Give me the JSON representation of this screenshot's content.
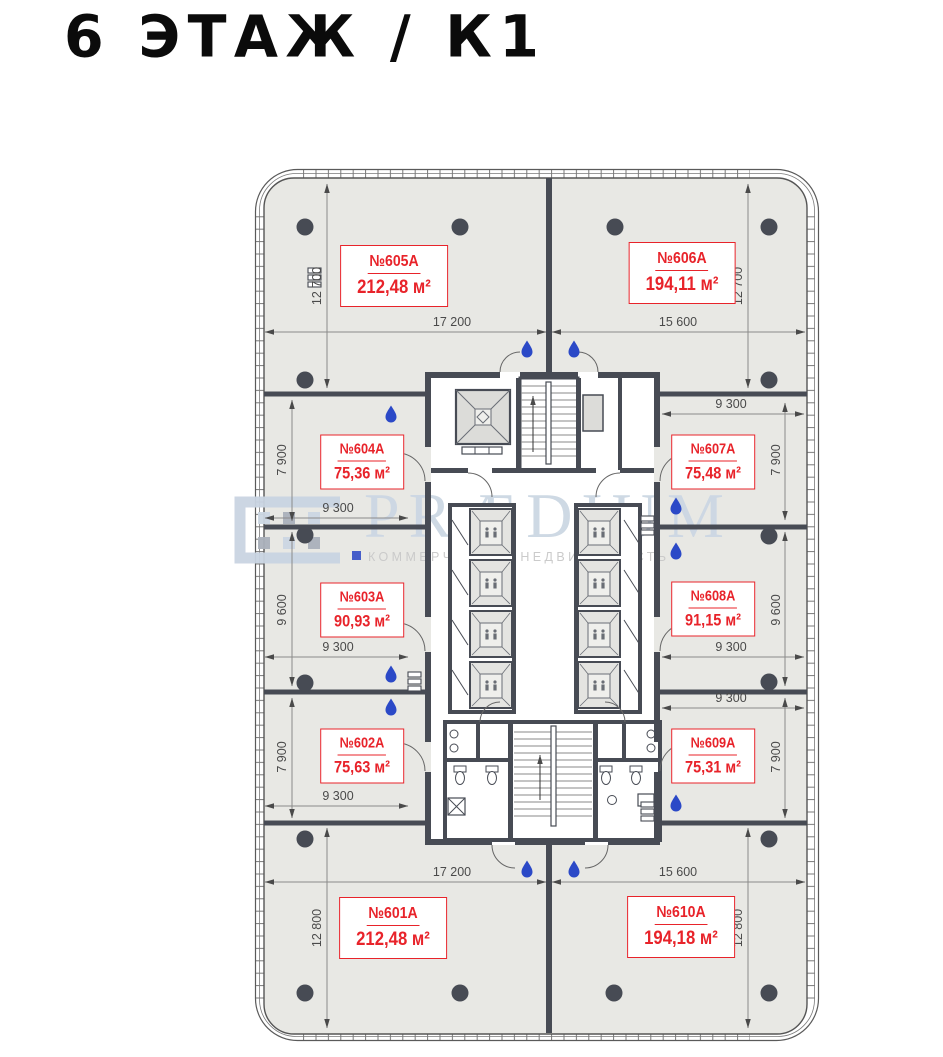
{
  "header": {
    "title": "6 ЭТАЖ / К1"
  },
  "units": [
    {
      "number": "№605А",
      "area": "212,48 м²"
    },
    {
      "number": "№606А",
      "area": "194,11 м²"
    },
    {
      "number": "№604А",
      "area": "75,36 м²"
    },
    {
      "number": "№607А",
      "area": "75,48 м²"
    },
    {
      "number": "№603А",
      "area": "90,93 м²"
    },
    {
      "number": "№608А",
      "area": "91,15 м²"
    },
    {
      "number": "№602А",
      "area": "75,63 м²"
    },
    {
      "number": "№609А",
      "area": "75,31 м²"
    },
    {
      "number": "№601А",
      "area": "212,48 м²"
    },
    {
      "number": "№610А",
      "area": "194,18 м²"
    }
  ],
  "dimensions": {
    "top": [
      "17 200",
      "15 600"
    ],
    "bottom": [
      "17 200",
      "15 600"
    ],
    "left": [
      "12 700",
      "7 900",
      "9 600",
      "7 900",
      "12 800"
    ],
    "right": [
      "12 700",
      "7 900",
      "9 600",
      "7 900",
      "12 800"
    ],
    "inner_left": [
      "9 300",
      "9 300",
      "9 300"
    ],
    "inner_right": [
      "9 300",
      "9 300",
      "9 300"
    ]
  },
  "watermark": {
    "brand": "PRÆDIUM",
    "subtitle": "КОММЕРЧЕСКАЯ НЕДВИЖИМОСТЬ"
  },
  "colors": {
    "unit_label_red": "#e8232a",
    "wall_dark": "#474b54",
    "floor_fill": "#e8e8e4",
    "water_drop_blue": "#2b49c7",
    "watermark_blue": "#ccd7e3",
    "dimension_text": "#4a4a4a"
  }
}
